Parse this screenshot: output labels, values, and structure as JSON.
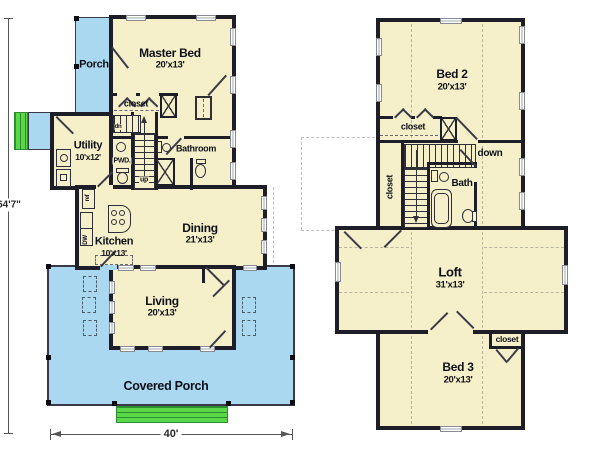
{
  "title": "Two-story house floor plan",
  "dimensions": {
    "overall_height": "64'7\"",
    "overall_width": "40'"
  },
  "first_floor": {
    "porch_label": "Porch",
    "covered_porch_label": "Covered Porch",
    "master_bed": {
      "name": "Master Bed",
      "dims": "20'x13'"
    },
    "closet_label": "closet",
    "utility": {
      "name": "Utility",
      "dims": "10'x12'"
    },
    "pwd_label": "PWD.",
    "bathroom_label": "Bathroom",
    "kitchen": {
      "name": "Kitchen",
      "dims": "10'x13'"
    },
    "dining": {
      "name": "Dining",
      "dims": "21'x13'"
    },
    "living": {
      "name": "Living",
      "dims": "20'x13'"
    },
    "dn_label": "dn",
    "up_label": "up",
    "ref_label": "ref",
    "dw_label": "DW"
  },
  "second_floor": {
    "bed2": {
      "name": "Bed 2",
      "dims": "20'x13'"
    },
    "bed3": {
      "name": "Bed 3",
      "dims": "20'x13'"
    },
    "loft": {
      "name": "Loft",
      "dims": "31'x13'"
    },
    "bath_label": "Bath",
    "down_label": "down",
    "closet_bed2_label": "closet",
    "closet_hall_label": "closet",
    "closet_bed3_label": "closet"
  },
  "colors": {
    "wall": "#1e1e29",
    "room": "#f5f0c9",
    "porch": "#a9d8f0",
    "green": "#5bd74a",
    "green_line": "#2e8d2e",
    "ink": "#10101a"
  }
}
